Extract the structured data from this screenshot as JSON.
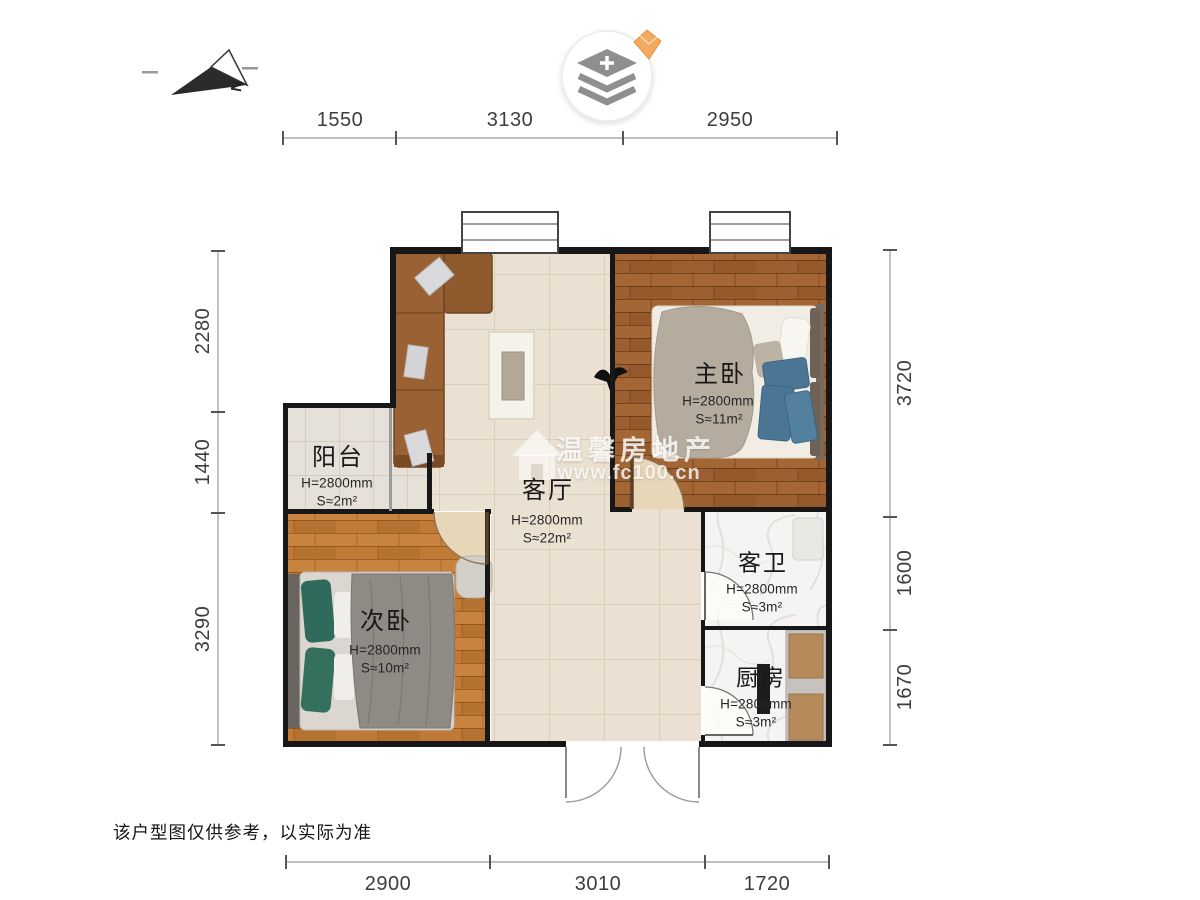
{
  "page": {
    "disclaimer": "该户型图仅供参考，以实际为准"
  },
  "compass": {
    "label": "N",
    "icon": "north-arrow-icon"
  },
  "map_control": {
    "icon": "layers-stack-icon",
    "badge_icon": "gem-icon"
  },
  "watermark": {
    "icon": "house-icon",
    "brand": "温馨房地产",
    "url": "www.fc100.cn"
  },
  "rooms": {
    "master": {
      "name": "主卧",
      "height": "H=2800mm",
      "area": "S≈11m²"
    },
    "living": {
      "name": "客厅",
      "height": "H=2800mm",
      "area": "S≈22m²"
    },
    "balcony": {
      "name": "阳台",
      "height": "H=2800mm",
      "area": "S≈2m²"
    },
    "second": {
      "name": "次卧",
      "height": "H=2800mm",
      "area": "S≈10m²"
    },
    "bath": {
      "name": "客卫",
      "height": "H=2800mm",
      "area": "S≈3m²"
    },
    "kitchen": {
      "name": "厨房",
      "height": "H=2800mm",
      "area": "S≈3m²"
    }
  },
  "dimensions": {
    "top": [
      "1550",
      "3130",
      "2950"
    ],
    "bottom": [
      "2900",
      "3010",
      "1720"
    ],
    "left": [
      "2280",
      "1440",
      "3290"
    ],
    "right": [
      "3720",
      "1600",
      "1670"
    ]
  },
  "colors": {
    "wood_master": "#9c5f31",
    "wood_second": "#c07a35",
    "tile_living": "#eae1d2",
    "wall": "#171717",
    "accent_gem": "#f2a75e",
    "blanket_blue": "#4a7594",
    "pillow_teal": "#2f6a5c"
  }
}
